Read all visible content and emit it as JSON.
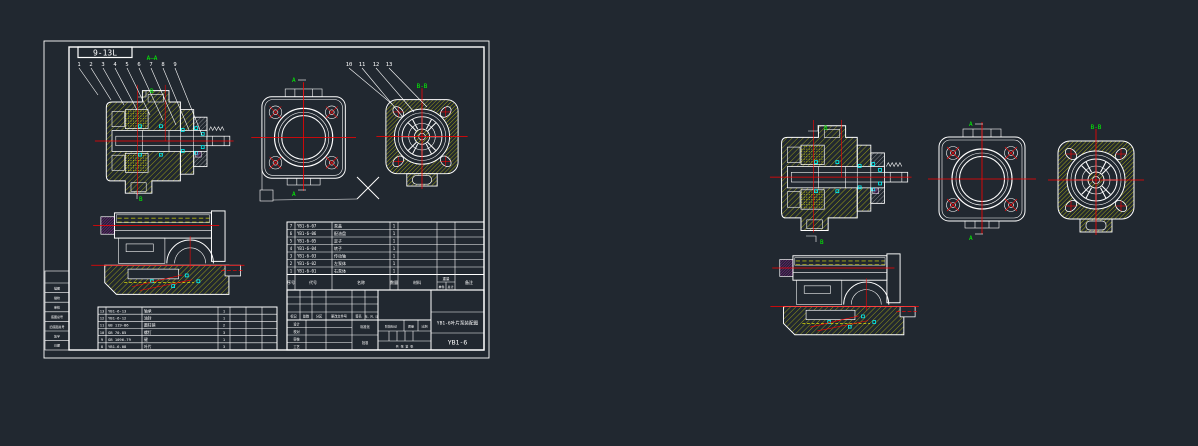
{
  "app": {
    "background": "#212830"
  },
  "colors": {
    "line": "#ffffff",
    "hatch": "#ffff00",
    "centerline": "#ff0000",
    "section_label": "#00ff00",
    "detail": "#00ffff",
    "seal": "#ff00ff"
  },
  "sheet": {
    "page_label": "9-13L"
  },
  "labels": {
    "section_aa": "A—A",
    "a": "A",
    "b": "B",
    "bb": "B-B"
  },
  "balloons": {
    "left": [
      "1",
      "2",
      "3",
      "4",
      "5",
      "6",
      "7",
      "8",
      "9"
    ],
    "right": [
      "10",
      "11",
      "12",
      "13"
    ]
  },
  "bom": {
    "headers": {
      "seq": "序号",
      "code": "代号",
      "name": "名称",
      "qty": "数量",
      "material": "材料",
      "weight": "重量",
      "unit": "单件",
      "total": "总计",
      "remark": "备注"
    },
    "parts": [
      {
        "seq": "7",
        "code": "YB1-6-07",
        "name": "泵盖",
        "qty": "1"
      },
      {
        "seq": "6",
        "code": "YB1-6-06",
        "name": "配油盘",
        "qty": "1"
      },
      {
        "seq": "5",
        "code": "YB1-6-05",
        "name": "定子",
        "qty": "1"
      },
      {
        "seq": "4",
        "code": "YB1-6-04",
        "name": "转子",
        "qty": "1"
      },
      {
        "seq": "3",
        "code": "YB1-6-03",
        "name": "传动轴",
        "qty": "1"
      },
      {
        "seq": "2",
        "code": "YB1-6-02",
        "name": "左泵体",
        "qty": "1"
      },
      {
        "seq": "1",
        "code": "YB1-6-01",
        "name": "右泵体",
        "qty": "1"
      }
    ],
    "std_parts": [
      {
        "seq": "13",
        "code": "YB1-6-13",
        "name": "轴承",
        "qty": "1"
      },
      {
        "seq": "12",
        "code": "YB1-6-12",
        "name": "油封",
        "qty": "1"
      },
      {
        "seq": "11",
        "code": "GB 119-86",
        "name": "圆柱销",
        "qty": "2"
      },
      {
        "seq": "10",
        "code": "GB 70-85",
        "name": "螺钉",
        "qty": "3"
      },
      {
        "seq": "9",
        "code": "GB 1096-79",
        "name": "键",
        "qty": "1"
      },
      {
        "seq": "8",
        "code": "YB1-6-08",
        "name": "叶片",
        "qty": "3"
      }
    ]
  },
  "title_block": {
    "revision_labels": [
      "标记",
      "处数",
      "分区",
      "更改文件号",
      "签名",
      "年、月、日"
    ],
    "role_labels": [
      "设计",
      "校对",
      "审核",
      "工艺"
    ],
    "approve_labels": [
      "标准化",
      "批准"
    ],
    "stage_label": "阶段标记",
    "mass_label": "质量",
    "scale_label": "比例",
    "sheets_text": "共 张 第 张",
    "drawing_name": "YB1-6叶片泵装配图",
    "drawing_number": "YB1-6"
  },
  "margin_strip": [
    "描图",
    "描校",
    "审核",
    "底图总号",
    "旧底图总号",
    "签字",
    "日期"
  ]
}
